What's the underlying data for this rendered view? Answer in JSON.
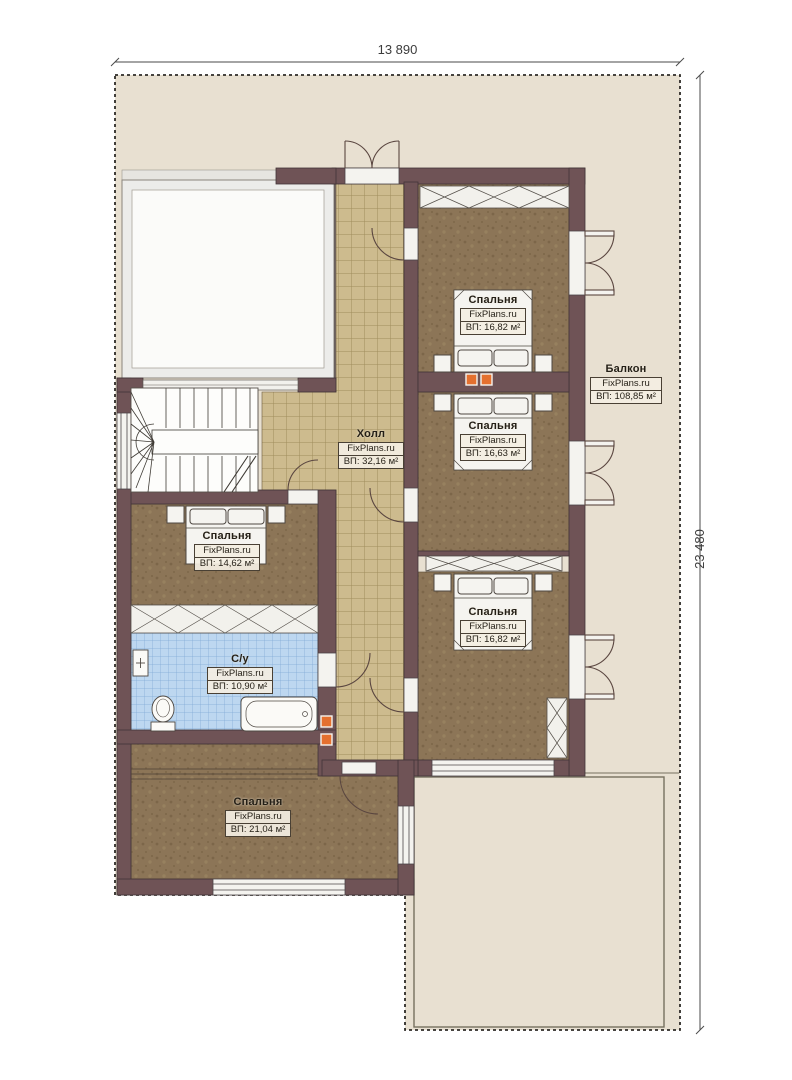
{
  "plan": {
    "dimensions": {
      "top": "13 890",
      "right": "23 480"
    },
    "rooms": {
      "bedroom_top_right": {
        "name": "Спальня",
        "watermark": "FixPlans.ru",
        "area": "ВП: 16,82 м²"
      },
      "bedroom_mid_right": {
        "name": "Спальня",
        "watermark": "FixPlans.ru",
        "area": "ВП: 16,63 м²"
      },
      "bedroom_bottom_right": {
        "name": "Спальня",
        "watermark": "FixPlans.ru",
        "area": "ВП: 16,82 м²"
      },
      "bedroom_left": {
        "name": "Спальня",
        "watermark": "FixPlans.ru",
        "area": "ВП: 14,62 м²"
      },
      "bedroom_bottom": {
        "name": "Спальня",
        "watermark": "FixPlans.ru",
        "area": "ВП: 21,04 м²"
      },
      "hall": {
        "name": "Холл",
        "watermark": "FixPlans.ru",
        "area": "ВП: 32,16 м²"
      },
      "bathroom": {
        "name": "С/у",
        "watermark": "FixPlans.ru",
        "area": "ВП: 10,90 м²"
      },
      "balcony": {
        "name": "Балкон",
        "watermark": "FixPlans.ru",
        "area": "ВП: 108,85 м²"
      }
    },
    "colors": {
      "site": "#e8e0d1",
      "wall": "#6f5356",
      "carpet": "#8c7557",
      "hall_tile": "#cdbb8e",
      "bath_tile": "#bdd7f0",
      "vent": "#e4702f"
    }
  }
}
